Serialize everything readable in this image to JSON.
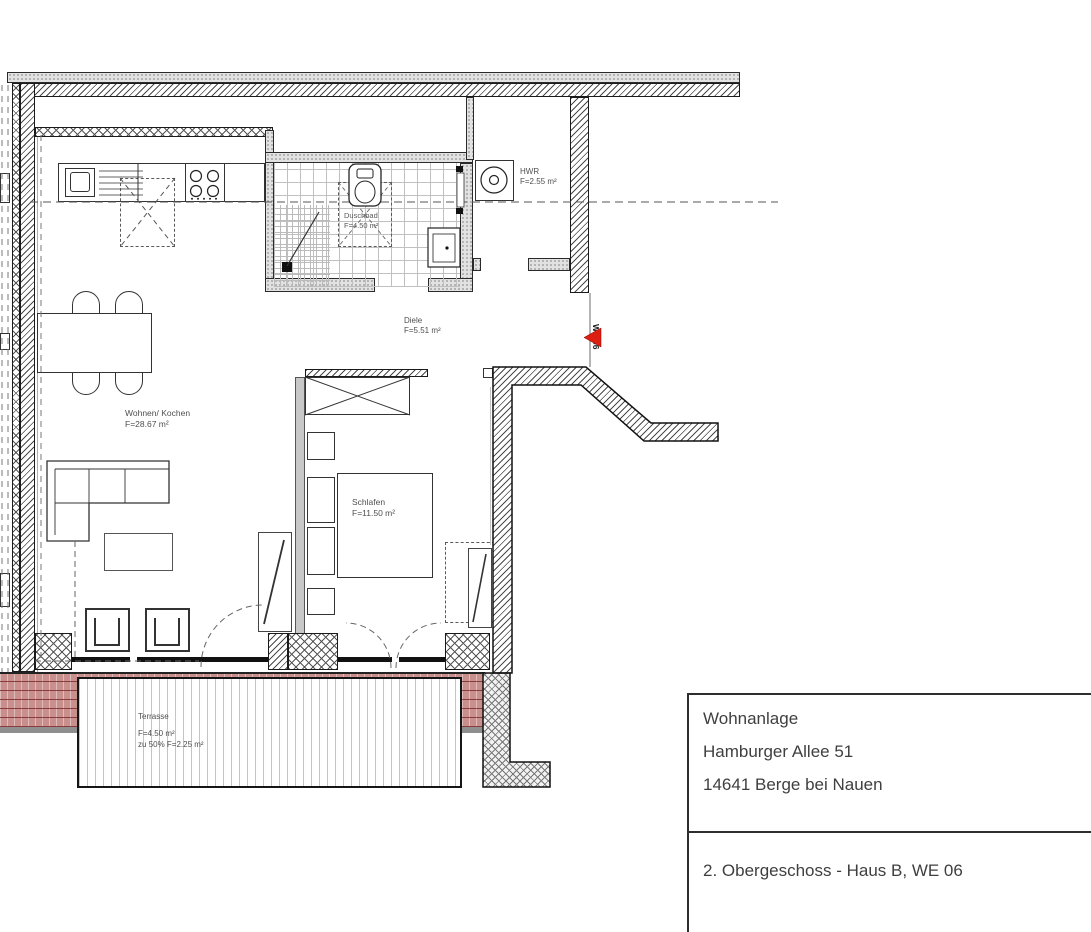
{
  "plan": {
    "unit_marker": "WE 06",
    "rooms": {
      "living": {
        "name": "Wohnen/ Kochen",
        "area": "F=28.67 m²"
      },
      "hall": {
        "name": "Diele",
        "area": "F=5.51 m²"
      },
      "bath": {
        "name": "Duschbad",
        "area": "F=4.50 m²"
      },
      "utility": {
        "name": "HWR",
        "area": "F=2.55 m²"
      },
      "bedroom": {
        "name": "Schlafen",
        "area": "F=11.50 m²"
      },
      "terrace": {
        "name": "Terrasse",
        "area": "F=4.50 m²",
        "area_50": "zu 50% F=2.25 m²"
      }
    }
  },
  "title_block": {
    "project": "Wohnanlage",
    "street": "Hamburger Allee 51",
    "city": "14641 Berge bei Nauen"
  },
  "drawing_label": {
    "text": "2. Obergeschoss - Haus B, WE 06"
  },
  "colors": {
    "roof_tile": "#c88f8d",
    "marker_red": "#dc1f10",
    "wall_line": "#3c3c3c"
  }
}
